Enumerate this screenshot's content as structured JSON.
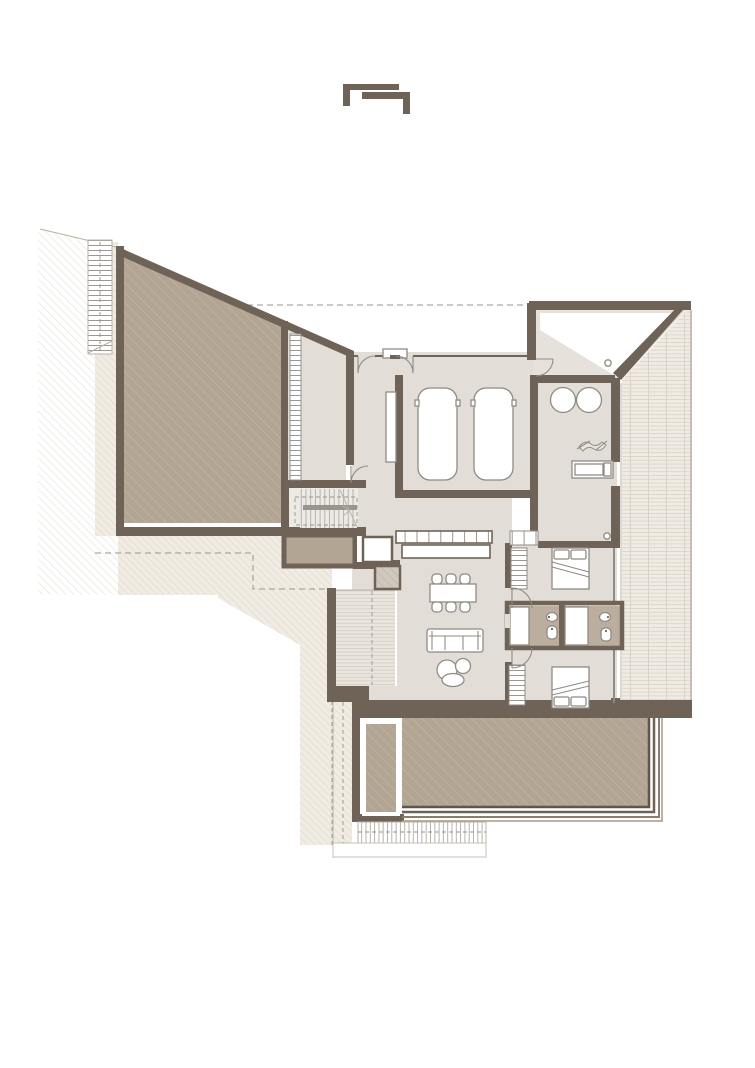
{
  "meta": {
    "type": "architectural-floor-plan",
    "visible_text": "none",
    "description": "Single-storey villa floor plan with carport, entry, utility room, two bedrooms with bathrooms between, open living-dining-kitchen, west wood deck, east tiled terrace, large hatched garage volume, sunken pool/ramp at south, exterior stairs, surrounding hatched terrain with dashed setback lines"
  },
  "logo": {
    "name": "interlocking-brackets-logo",
    "glyph": "two offset angle brackets"
  },
  "colors": {
    "background": "#ffffff",
    "wall": "#6e6356",
    "wall_dark": "#5f554a",
    "floor": "#e2ded7",
    "floor_entry": "#e6e2db",
    "solid_fill": "#b3a593",
    "solid_hatch_line": "#c6b9a7",
    "bath_floor": "#bcae9f",
    "deck_bg": "#eae6df",
    "deck_line": "#d5cec3",
    "terrace_bg": "#f0ece5",
    "terrace_line": "#ddd5c9",
    "site_line": "#e7e1d7",
    "site_tint": "#f0ebe3",
    "outline": "#8f8b84",
    "thin": "#b9b2a6",
    "dash": "#9a958c",
    "furniture_fill": "#ffffff",
    "logo": "#6e6356",
    "step1": "#5f554a",
    "step2": "#6e6356",
    "step3": "#8a7d6e",
    "step4": "#a69884"
  },
  "legend": {
    "rooms": [
      "garage-volume",
      "storeroom",
      "interior-stair",
      "storage-room",
      "carport",
      "entry",
      "utility-room",
      "hallway",
      "living-dining-kitchen",
      "bedroom-north",
      "bathroom-band",
      "bedroom-south",
      "west-deck",
      "east-terrace",
      "pool-ramp"
    ],
    "furniture": [
      "car x2",
      "washer",
      "dryer",
      "motorcycle",
      "workbench",
      "kitchen-cabinets",
      "kitchen-island",
      "dining-table",
      "chair x6",
      "sofa",
      "coffee-tables",
      "bed x2",
      "wardrobe x3",
      "shower x2",
      "basin x2",
      "wc x2",
      "fireplace",
      "chimney"
    ],
    "site": [
      "diagonal-hatch-terrain",
      "setback-dashed-line",
      "roof-overhang-dashed-line",
      "exterior-stair-west",
      "exterior-stair-south",
      "ladder-rungs"
    ]
  }
}
